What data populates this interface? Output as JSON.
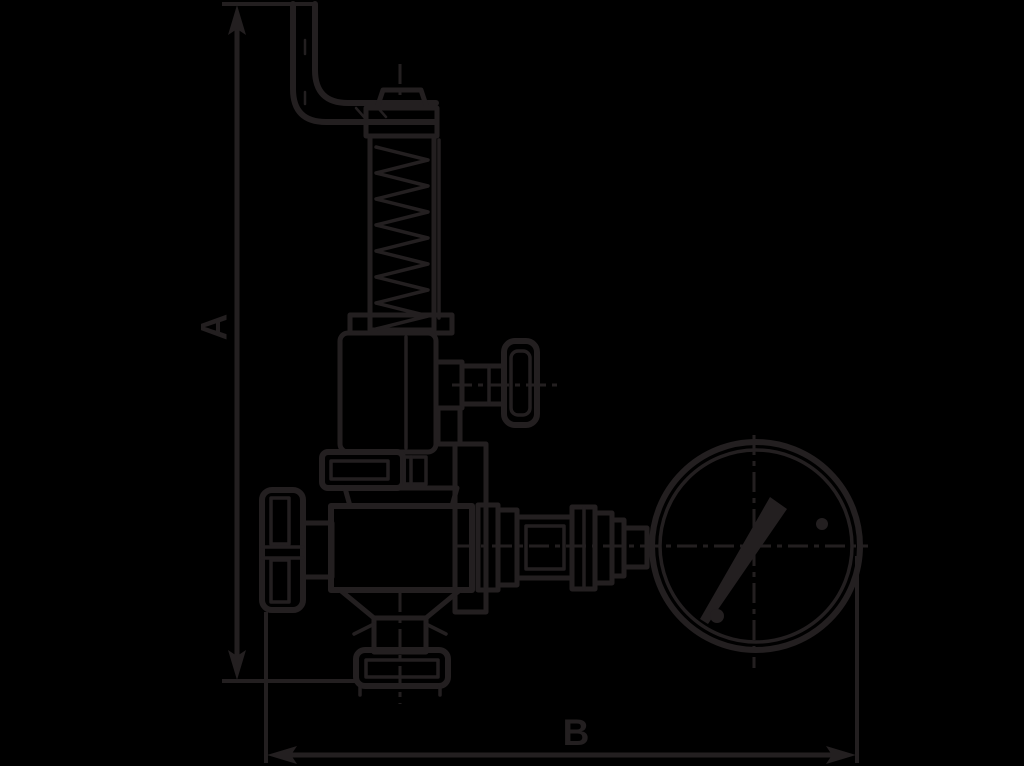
{
  "drawing": {
    "dimension_labels": {
      "height": "A",
      "width": "B"
    }
  },
  "colors": {
    "background": "#000000",
    "ink": "#231f20"
  },
  "parts": [
    "lifting-lever",
    "cap-nut",
    "spring-housing",
    "coil-spring",
    "bonnet",
    "test-knob",
    "union-nut",
    "valve-body",
    "handwheel",
    "outlet-pipe",
    "outlet-flange",
    "pipe-fittings",
    "pressure-gauge",
    "gauge-needle",
    "dimension-line-a",
    "dimension-line-b"
  ]
}
